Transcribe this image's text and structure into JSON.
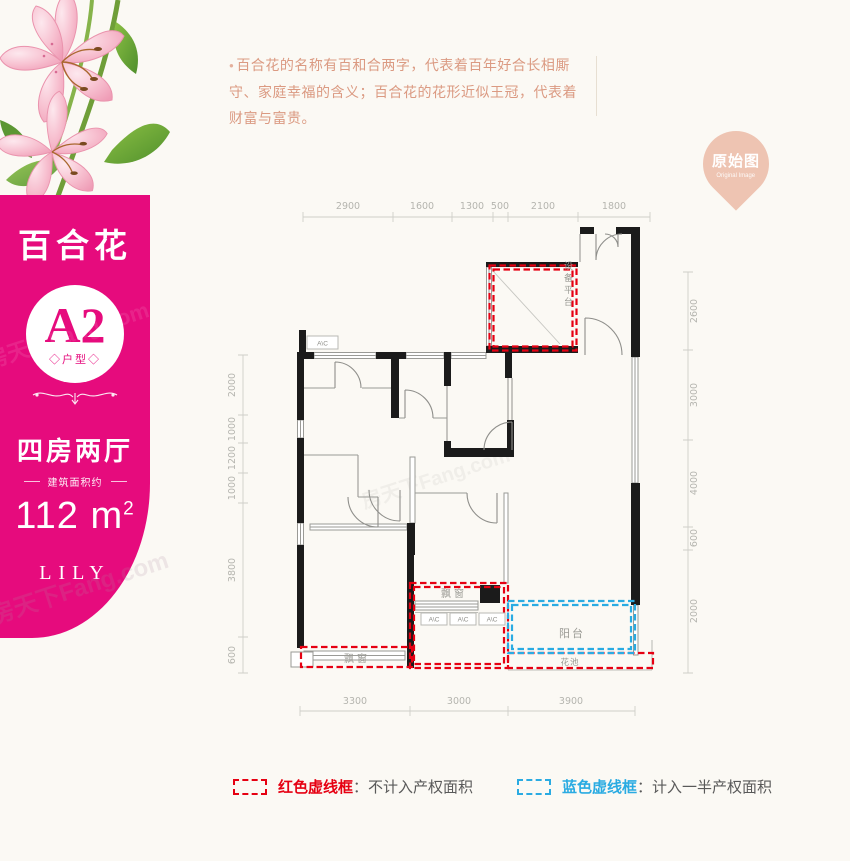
{
  "sidebar": {
    "accent": "#e60b7d",
    "title": "百合花",
    "unit_code": "A2",
    "unit_label": "◇户型◇",
    "rooms": "四房两厅",
    "area_note": "建筑面积约",
    "area_value": "112",
    "area_unit": "m",
    "area_sup": "2",
    "name_en": "LILY",
    "watermark": "房天下Fang.com"
  },
  "description": {
    "bullet": "●",
    "text": "百合花的名称有百和合两字，代表着百年好合长相厮守、家庭幸福的含义；百合花的花形近似王冠，代表着财富与富贵。"
  },
  "badge": {
    "label": "原始图",
    "sublabel": "Original Image",
    "color": "#eec4b2"
  },
  "floorplan": {
    "dims_top": [
      "2900",
      "1600",
      "1300",
      "500",
      "2100",
      "1800"
    ],
    "dims_bottom": [
      "3300",
      "3000",
      "3900"
    ],
    "dims_left": [
      "2000",
      "1000",
      "1200",
      "1000",
      "3800",
      "600"
    ],
    "dims_right": [
      "2600",
      "3000",
      "4000",
      "600",
      "2000"
    ],
    "labels": {
      "equipment_platform": "设备平台",
      "bay_window": "飘窗",
      "balcony": "阳台",
      "flower_bed": "花池",
      "ac": "A\\C"
    },
    "colors": {
      "red": "#e60012",
      "blue": "#2aabe2",
      "wall": "#1b1b1b",
      "dim": "#b5b5af"
    }
  },
  "legend": {
    "red_label": "红色虚线框",
    "red_desc": "：不计入产权面积",
    "blue_label": "蓝色虚线框",
    "blue_desc": "：计入一半产权面积"
  }
}
